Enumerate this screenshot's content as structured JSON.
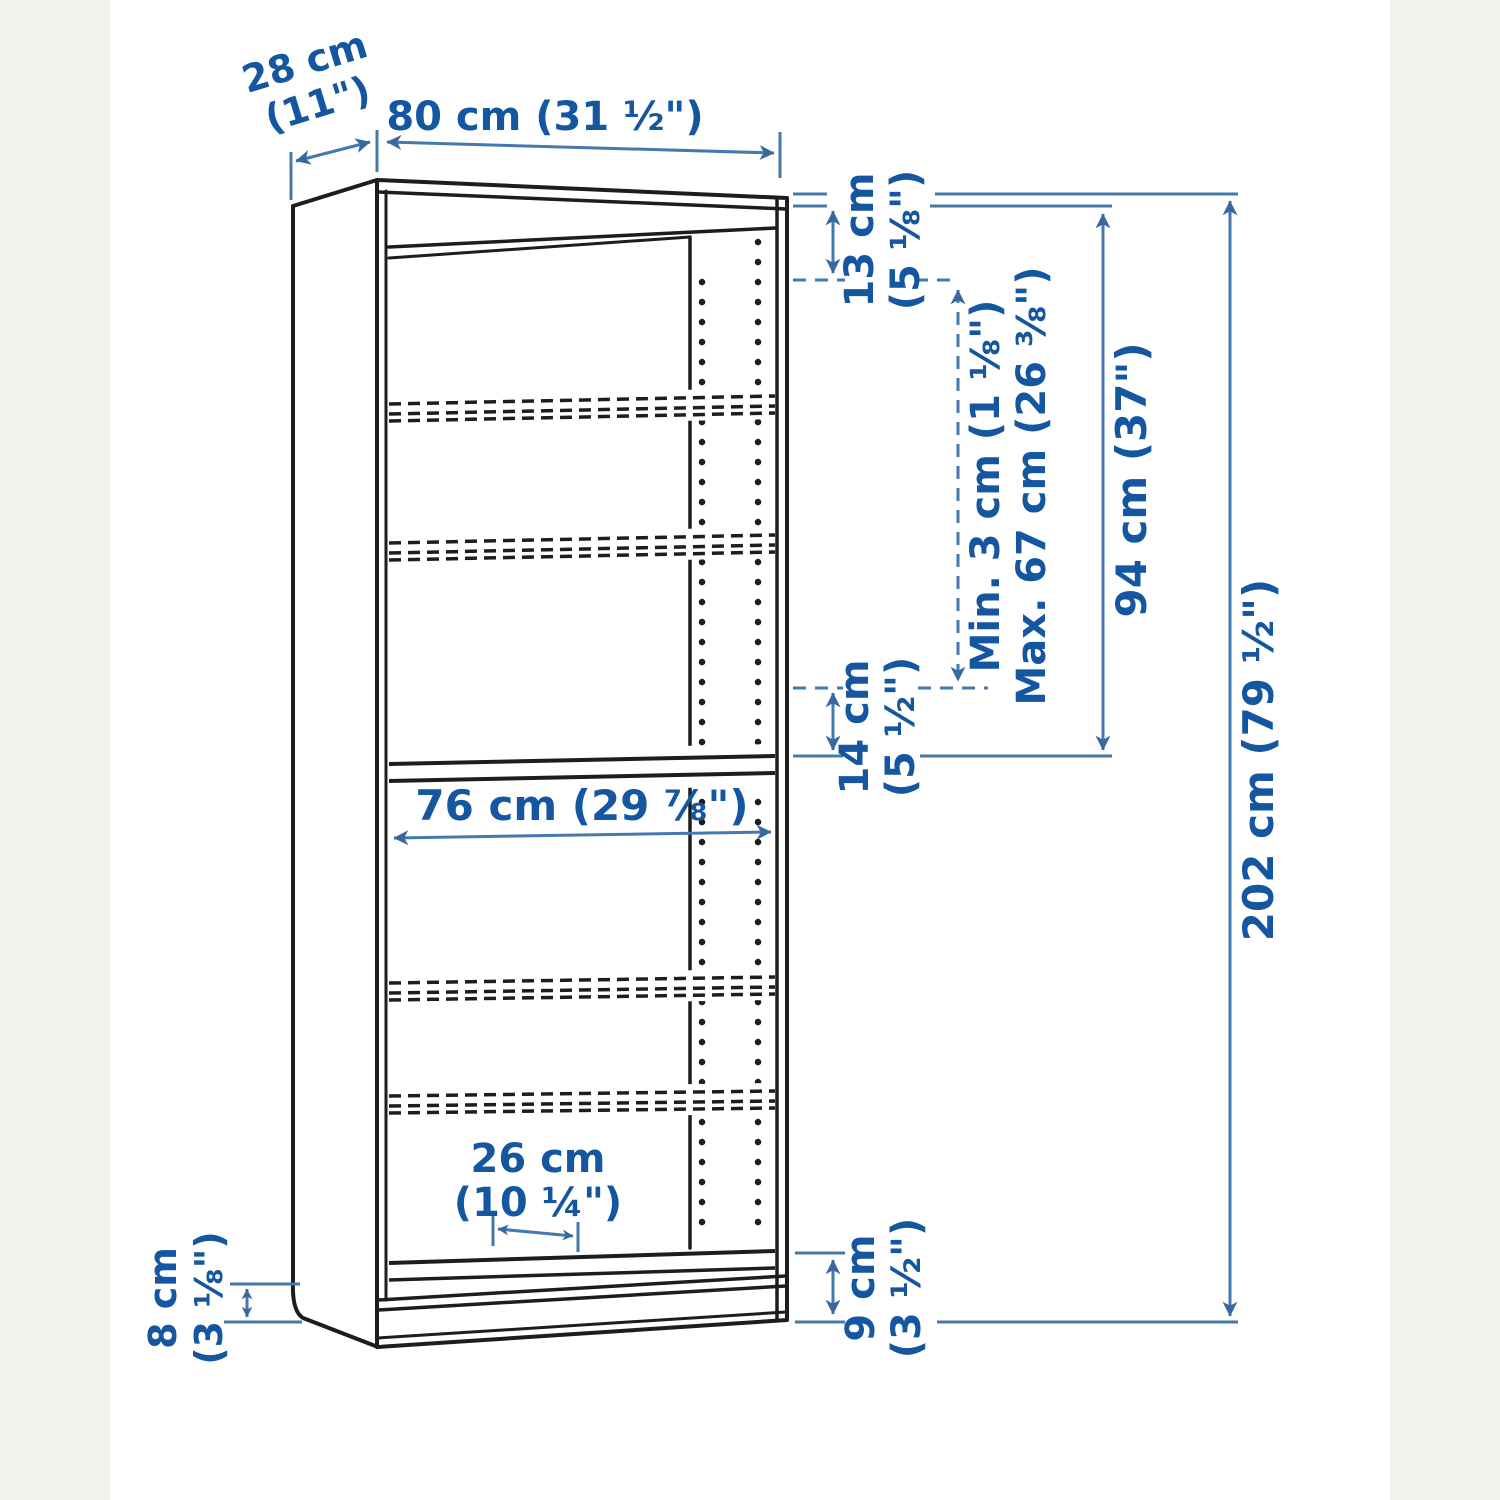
{
  "page": {
    "background": "#ffffff",
    "margin_strip_color": "#f3f1ee"
  },
  "diagram": {
    "product": "Bookcase dimension diagram",
    "colors": {
      "outline_black": "#1d1d1b",
      "dimension_line_blue": "#4579ad",
      "dimension_text_blue": "#1456a0"
    },
    "dims": {
      "depth_cm": "28 cm",
      "depth_in": "(11\")",
      "width": "80 cm (31 ½\")",
      "top_gap_cm": "13 cm",
      "top_gap_in": "(5 ⅛\")",
      "shelf_min": "Min. 3 cm (1 ⅛\")",
      "shelf_max": "Max. 67 cm (26 ⅜\")",
      "upper_section": "94 cm (37\")",
      "mid_gap_cm": "14 cm",
      "mid_gap_in": "(5 ½\")",
      "inner_width": "76 cm (29 ⅞\")",
      "height": "202 cm (79 ½\")",
      "shelf_depth_cm": "26 cm",
      "shelf_depth_in": "(10 ¼\")",
      "base_side_cm": "8 cm",
      "base_side_in": "(3 ⅛\")",
      "base_front_cm": "9 cm",
      "base_front_in": "(3 ½\")"
    }
  }
}
